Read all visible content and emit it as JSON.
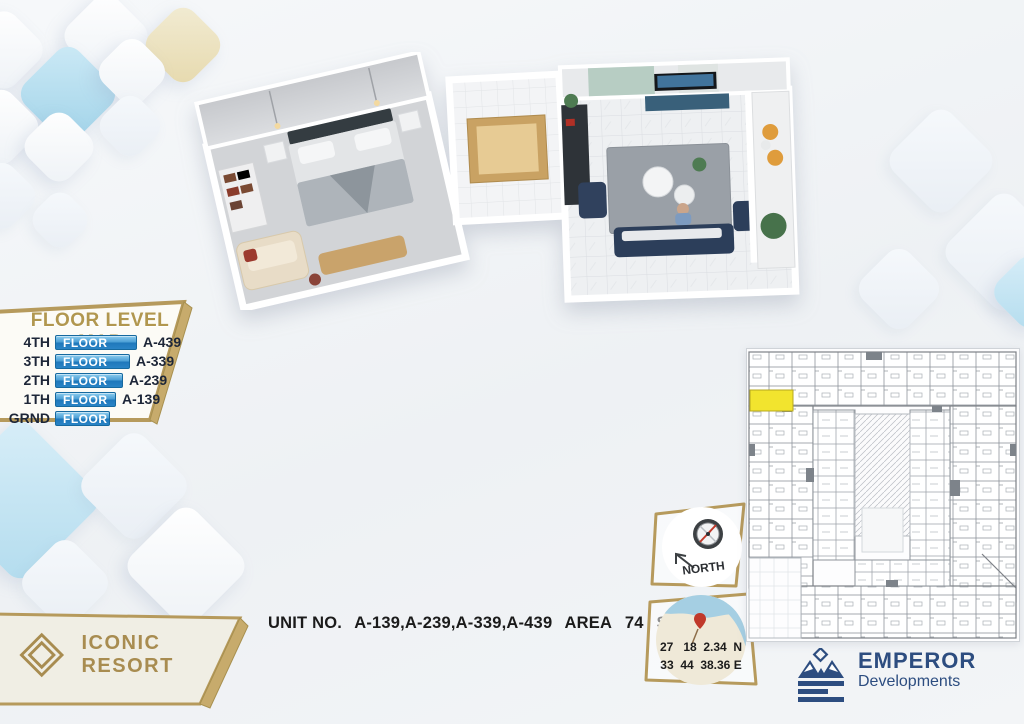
{
  "floor_level_map": {
    "title": "FLOOR LEVEL MAP",
    "rows": [
      {
        "level": "4TH",
        "bar_label": "FLOOR",
        "unit": "A-439"
      },
      {
        "level": "3TH",
        "bar_label": "FLOOR",
        "unit": "A-339"
      },
      {
        "level": "2TH",
        "bar_label": "FLOOR",
        "unit": "A-239"
      },
      {
        "level": "1TH",
        "bar_label": "FLOOR",
        "unit": "A-139"
      },
      {
        "level": "GRND",
        "bar_label": "FLOOR",
        "unit": ""
      }
    ]
  },
  "unit_info": {
    "label": "UNIT NO.",
    "units": "A-139,A-239,A-339,A-439",
    "area_label": "AREA",
    "area_value": "74",
    "area_unit": "SQM"
  },
  "compass": {
    "label": "NORTH"
  },
  "location": {
    "latitude": "27   18  2.34  N",
    "longitude": "33  44  38.36 E"
  },
  "brand": {
    "resort_name": "ICONIC RESORT",
    "developer_name": "EMPEROR",
    "developer_subtitle": "Developments"
  },
  "colors": {
    "gold": "#b69a5c",
    "bar_blue": "#2a7fc0",
    "logo_blue": "#2d4d80",
    "highlight_yellow": "#f2e42e",
    "title_gold": "#b1974f"
  }
}
